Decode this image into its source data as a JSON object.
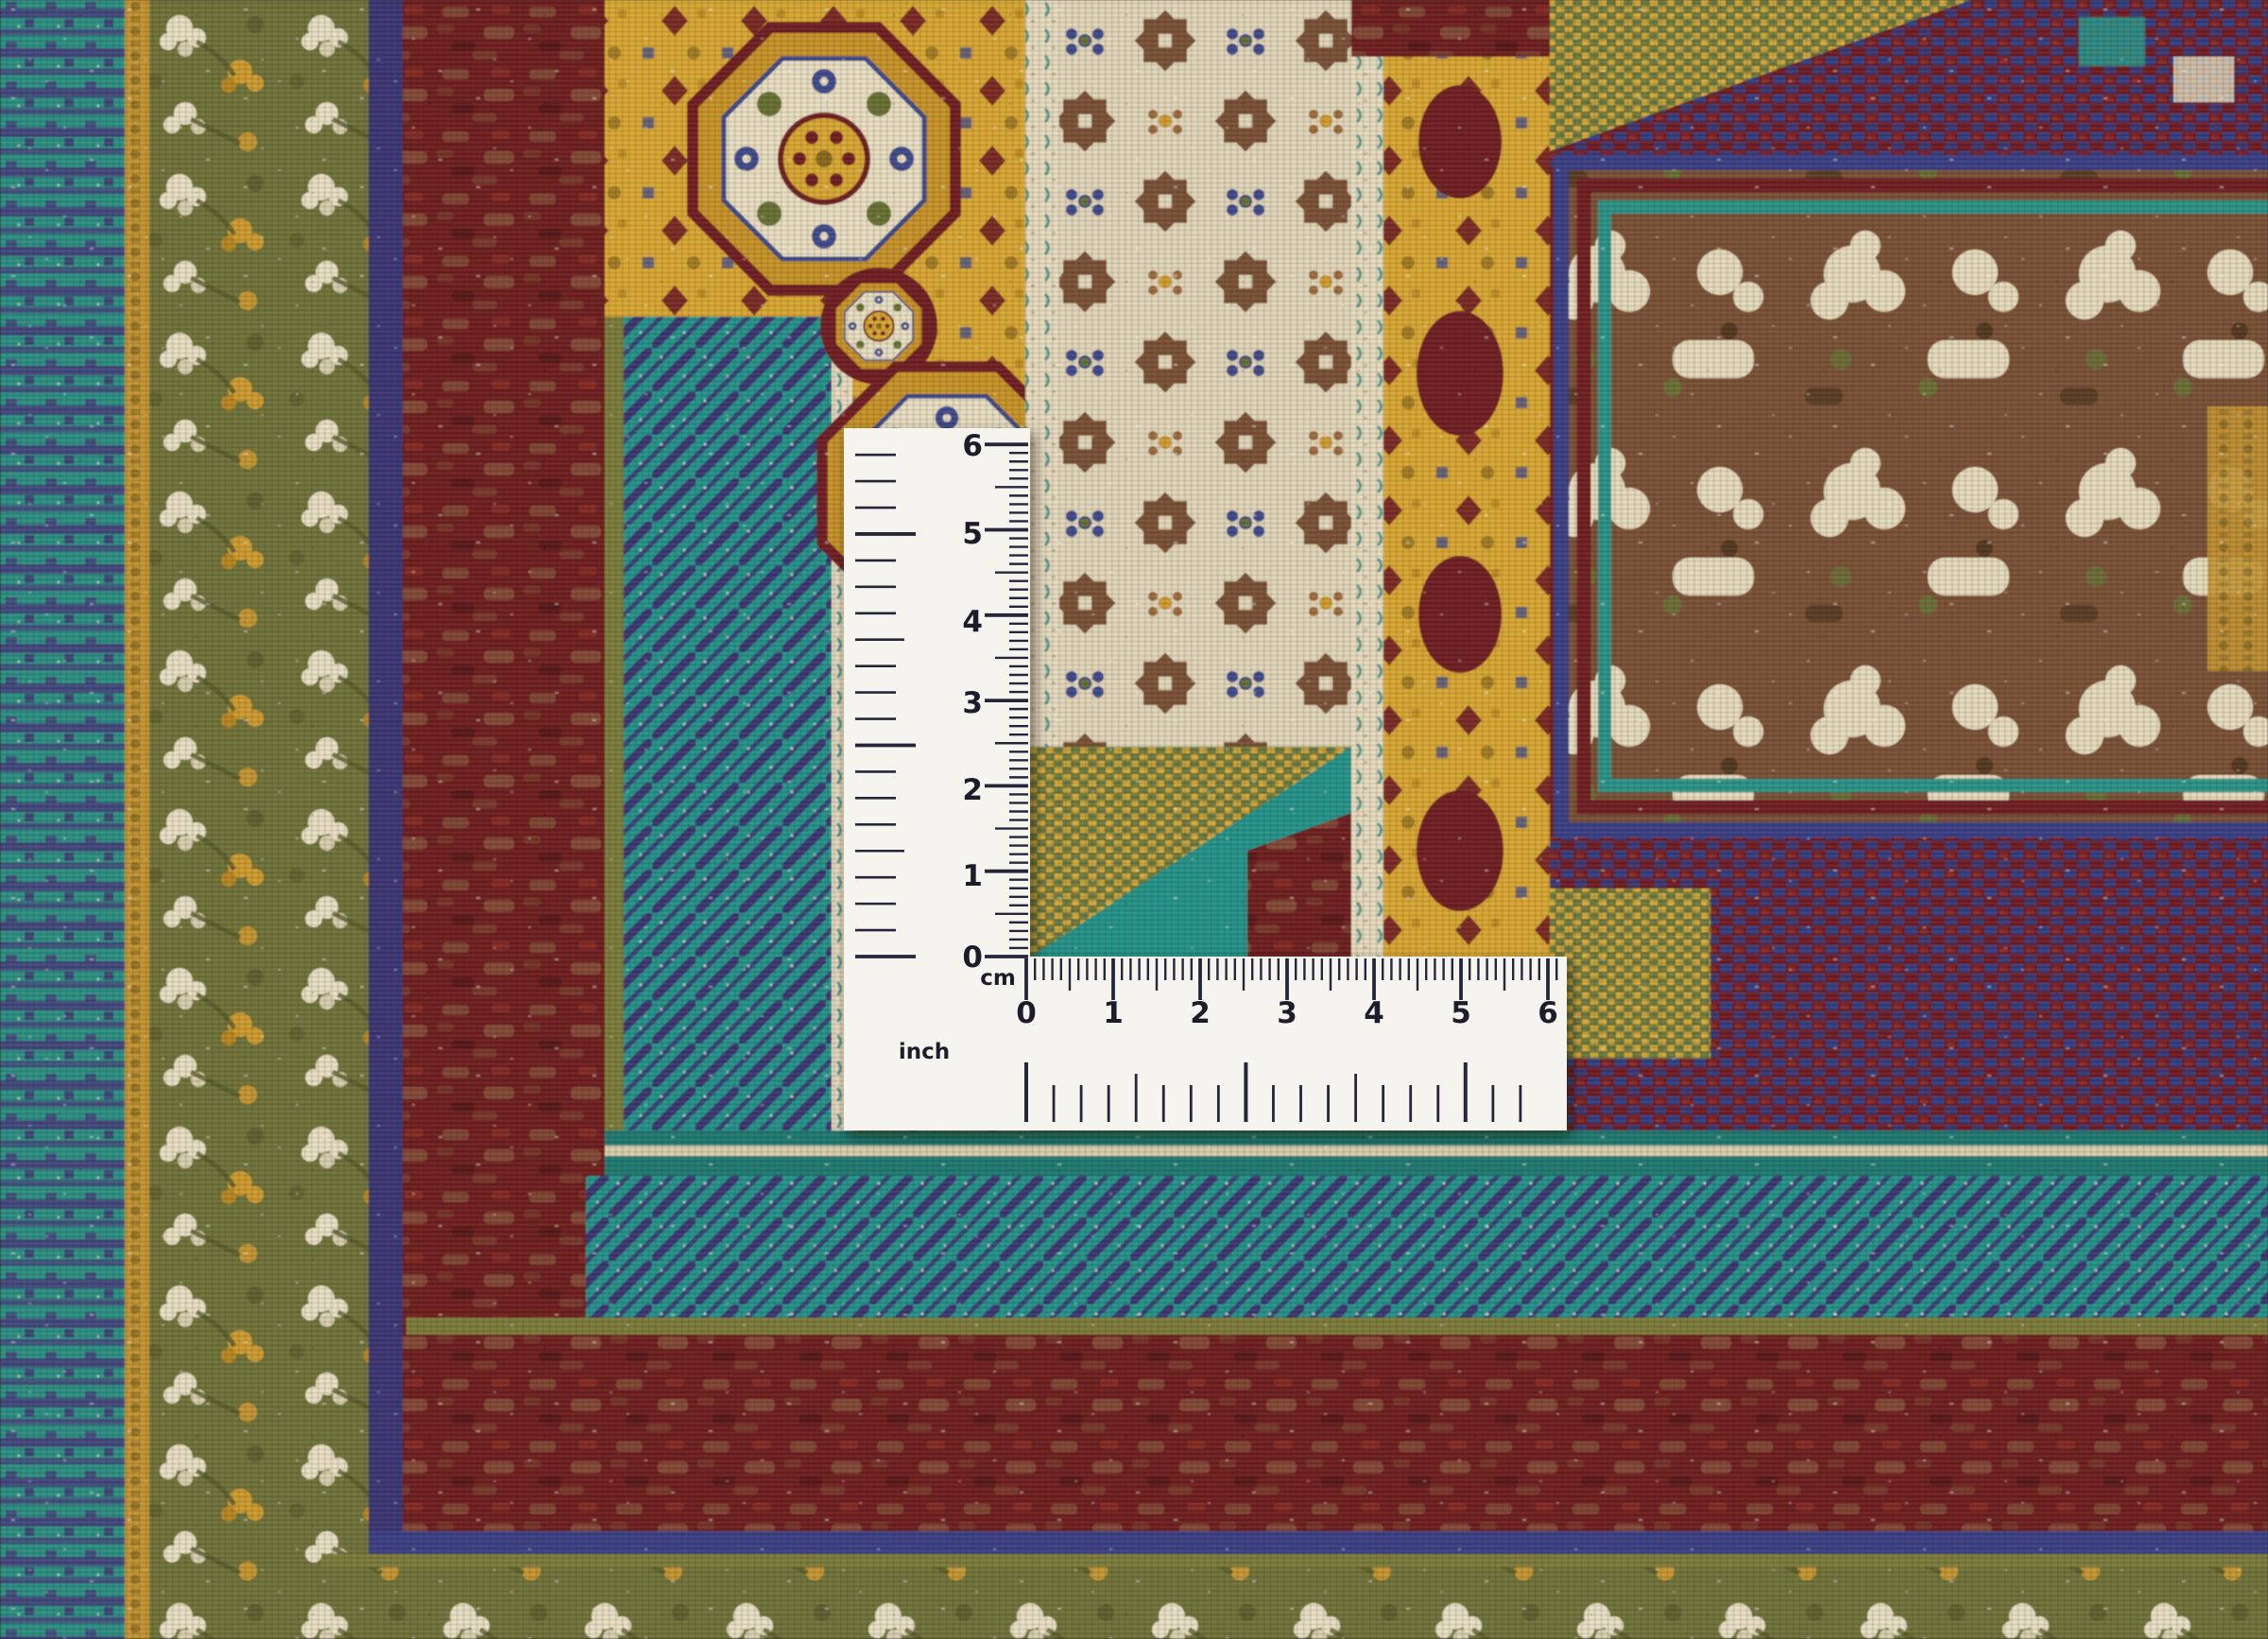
{
  "scene": {
    "subject": "Close-up photograph of a hand-knotted oriental carpet corner with multicoloured border bands and medallions",
    "overlay": "White L-shaped measuring ruler showing centimetre and inch scales"
  },
  "ruler": {
    "cm_unit_label": "cm",
    "inch_unit_label": "inch",
    "vertical_cm_numbers": [
      "6",
      "5",
      "4",
      "3",
      "2",
      "1",
      "0"
    ],
    "horizontal_cm_numbers": [
      "0",
      "1",
      "2",
      "3",
      "4",
      "5",
      "6"
    ]
  },
  "palette": {
    "ruler_white": "#f6f4ef",
    "tick_ink": "#26263a",
    "teal": "#22948a",
    "indigo": "#3b3472",
    "maroon": "#6e1d1d",
    "gold": "#d9a832",
    "olive_green": "#6f7339",
    "ivory": "#e7dcbf",
    "brown": "#7a5136",
    "blue": "#3a4086",
    "tan_mottle": "#9a7550",
    "green_gold": "#6d7a3c"
  }
}
